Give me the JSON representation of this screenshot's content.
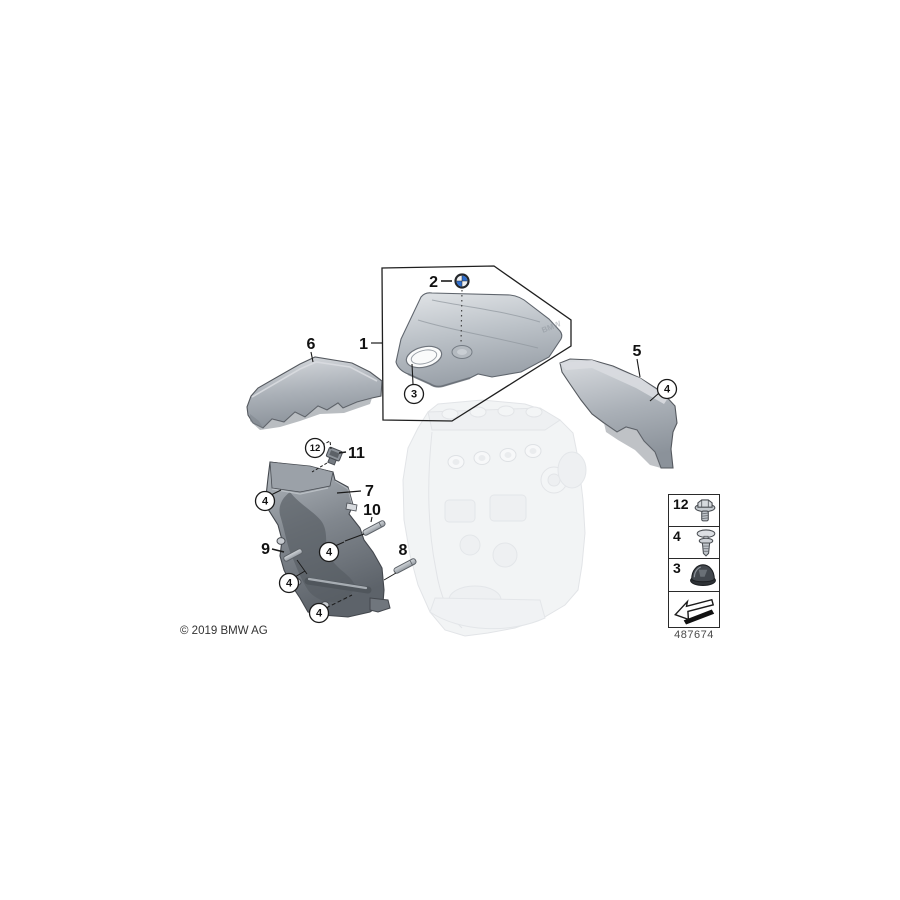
{
  "page": {
    "background": "#ffffff",
    "type": "bmw-parts-diagram"
  },
  "callouts": {
    "n1": "1",
    "n2": "2",
    "n3": "3",
    "n4": "4",
    "n5": "5",
    "n6": "6",
    "n7": "7",
    "n8": "8",
    "n9": "9",
    "n10": "10",
    "n11": "11",
    "n12": "12"
  },
  "emblem": {
    "icon": "bmw-roundel-icon",
    "embossed_text": "BMW"
  },
  "legend": {
    "rows": [
      {
        "number": "12",
        "icon": "hex-bolt-icon"
      },
      {
        "number": "4",
        "icon": "expansion-rivet-icon"
      },
      {
        "number": "3",
        "icon": "rubber-grommet-icon"
      }
    ],
    "arrow_icon": "direction-arrow-icon",
    "diagram_number": "487674"
  },
  "footer": {
    "copyright": "© 2019 BMW AG"
  },
  "colors": {
    "line": "#1a1a1a",
    "cover_light": "#dfe2e5",
    "cover_mid": "#b4bac1",
    "cover_dark": "#8a9199",
    "part7_dark": "#636970",
    "engine_faded": "#e7eaed",
    "roundel_blue": "#2f6fce"
  }
}
